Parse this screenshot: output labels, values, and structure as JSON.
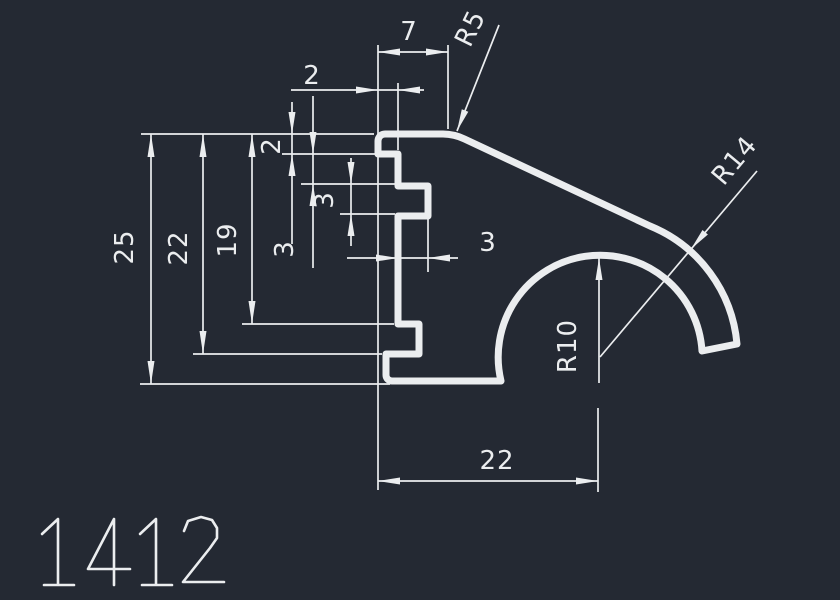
{
  "part_number": "1412",
  "colors": {
    "background": "#242933",
    "line": "#ebedef"
  },
  "dimensions": {
    "top_tab_width": "7",
    "top_tab_depth": "2",
    "top_tab_height": "2",
    "tab_to_notch": "3",
    "notch_height": "3",
    "notch_depth": "3",
    "overall_height": "25",
    "height_to_step": "22",
    "height_to_lower_tab": "19",
    "bottom_width": "22",
    "top_corner_radius": "R5",
    "outer_hook_radius": "R14",
    "arch_radius": "R10"
  }
}
